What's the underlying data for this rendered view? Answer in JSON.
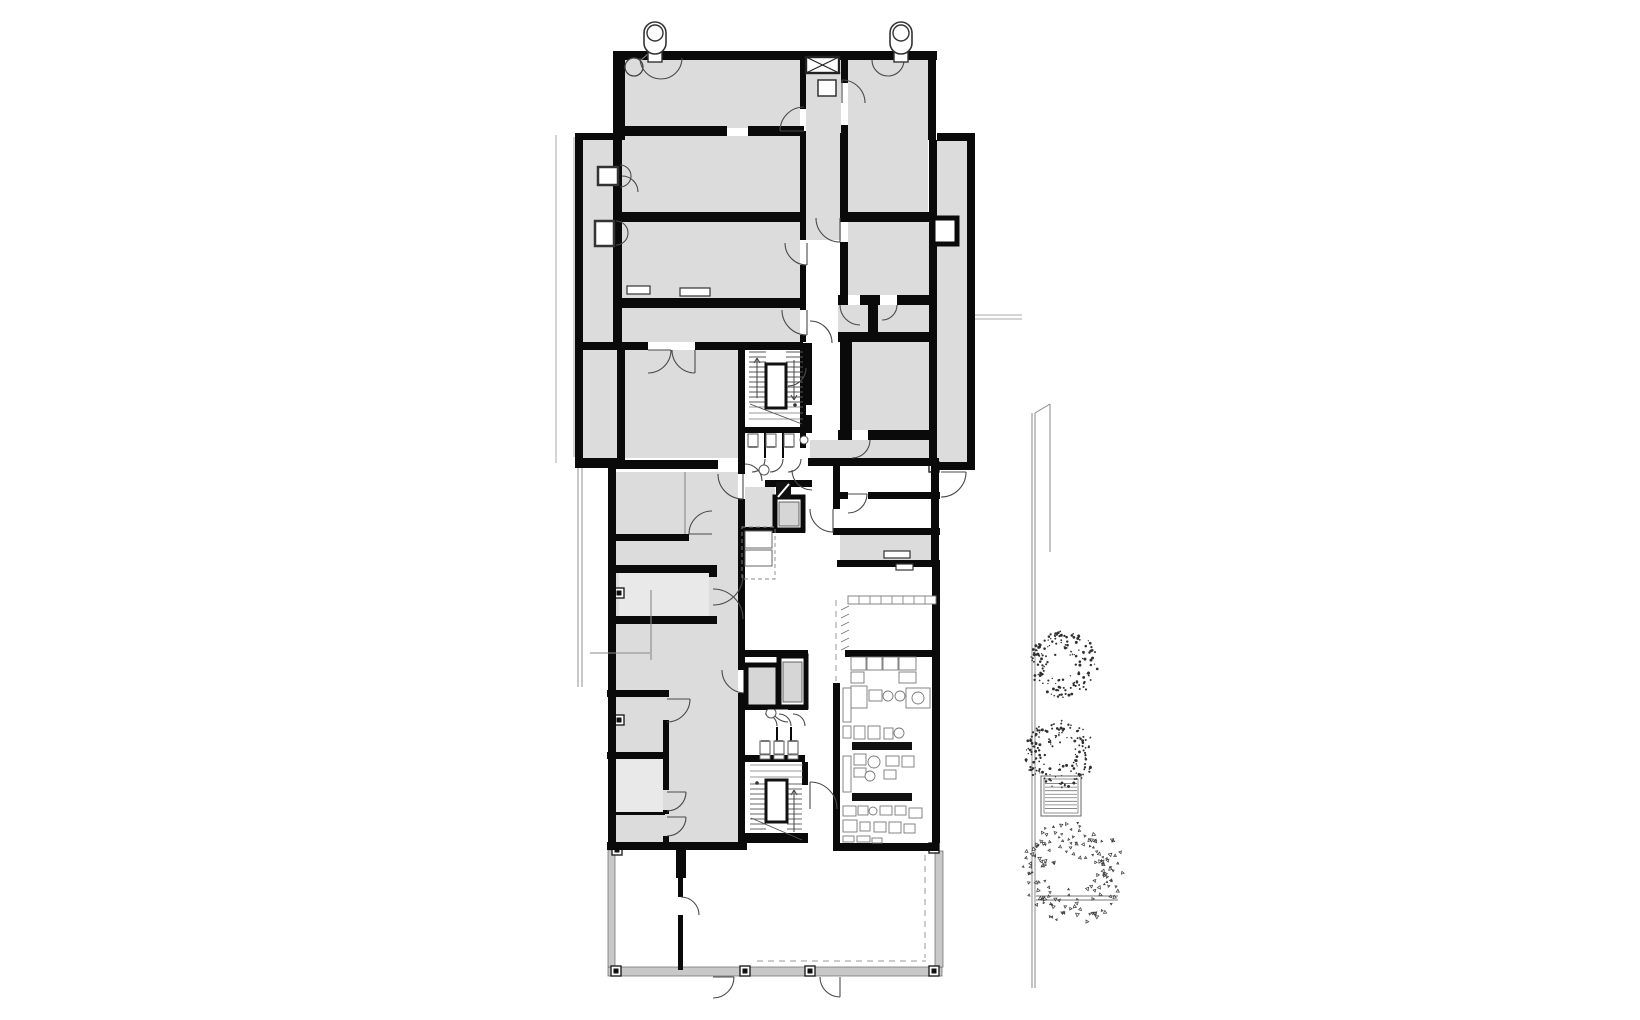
{
  "canvas": {
    "w": 1640,
    "h": 1020
  },
  "palette": {
    "wall": "#0a0a0a",
    "room": "#dcdcdc",
    "room_light": "#e9e9e9",
    "car": "#d6d6d6",
    "sill": "#c8c8c8",
    "door_line": "#4a4a4a",
    "equip_line": "#787878",
    "thin_line": "#a8a8a8",
    "glass_line": "#8f8f8f",
    "tree_dot": "#2f2f2f",
    "white": "#ffffff"
  },
  "fills": [
    [
      "r",
      625,
      60,
      175,
      68
    ],
    [
      "r",
      806,
      72,
      35,
      168
    ],
    [
      "r",
      848,
      60,
      80,
      152
    ],
    [
      "r",
      583,
      140,
      30,
      318
    ],
    [
      "r",
      622,
      136,
      178,
      76
    ],
    [
      "r",
      613,
      222,
      187,
      76
    ],
    [
      "r",
      613,
      308,
      187,
      34
    ],
    [
      "r",
      583,
      350,
      155,
      108
    ],
    [
      "r",
      848,
      222,
      82,
      73
    ],
    [
      "r",
      838,
      305,
      30,
      27
    ],
    [
      "r",
      878,
      305,
      52,
      27
    ],
    [
      "r",
      852,
      342,
      78,
      88
    ],
    [
      "r",
      810,
      440,
      120,
      18
    ],
    [
      "r",
      937,
      141,
      30,
      321
    ],
    [
      "r",
      615,
      472,
      123,
      371
    ],
    [
      "rl",
      619,
      573,
      90,
      43
    ],
    [
      "r",
      615,
      697,
      48,
      55
    ],
    [
      "rl",
      613,
      759,
      50,
      53
    ],
    [
      "r",
      613,
      815,
      50,
      27
    ],
    [
      "r",
      840,
      535,
      92,
      25
    ],
    [
      "r",
      745,
      487,
      30,
      40
    ]
  ],
  "walls": [
    [
      613,
      51,
      324,
      9
    ],
    [
      613,
      51,
      12,
      89
    ],
    [
      928,
      51,
      8,
      89
    ],
    [
      800,
      51,
      6,
      58
    ],
    [
      800,
      131,
      6,
      109
    ],
    [
      800,
      265,
      6,
      45
    ],
    [
      800,
      335,
      6,
      7
    ],
    [
      800,
      350,
      6,
      98
    ],
    [
      841,
      51,
      7,
      32
    ],
    [
      841,
      125,
      7,
      8
    ],
    [
      840,
      133,
      8,
      85
    ],
    [
      840,
      242,
      8,
      53
    ],
    [
      617,
      126,
      110,
      10
    ],
    [
      748,
      126,
      56,
      10
    ],
    [
      840,
      212,
      95,
      10
    ],
    [
      575,
      133,
      8,
      332
    ],
    [
      575,
      133,
      42,
      7
    ],
    [
      937,
      133,
      38,
      8
    ],
    [
      967,
      133,
      8,
      337
    ],
    [
      575,
      458,
      48,
      10
    ],
    [
      937,
      462,
      38,
      8
    ],
    [
      929,
      140,
      8,
      322
    ],
    [
      613,
      60,
      9,
      282
    ],
    [
      617,
      350,
      8,
      110
    ],
    [
      613,
      212,
      190,
      10
    ],
    [
      622,
      298,
      181,
      10
    ],
    [
      578,
      342,
      70,
      8
    ],
    [
      695,
      342,
      108,
      8
    ],
    [
      838,
      295,
      10,
      10
    ],
    [
      860,
      295,
      20,
      10
    ],
    [
      897,
      295,
      33,
      10
    ],
    [
      868,
      295,
      10,
      40
    ],
    [
      838,
      332,
      95,
      10
    ],
    [
      840,
      342,
      12,
      95
    ],
    [
      838,
      430,
      14,
      10
    ],
    [
      868,
      430,
      65,
      10
    ],
    [
      808,
      458,
      131,
      8
    ],
    [
      608,
      465,
      8,
      385
    ],
    [
      613,
      460,
      105,
      9
    ],
    [
      738,
      342,
      7,
      118
    ],
    [
      738,
      460,
      7,
      14
    ],
    [
      738,
      499,
      7,
      171
    ],
    [
      738,
      693,
      7,
      150
    ],
    [
      611,
      565,
      106,
      8
    ],
    [
      611,
      616,
      106,
      8
    ],
    [
      709,
      565,
      8,
      12
    ],
    [
      709,
      617,
      8,
      7
    ],
    [
      611,
      534,
      78,
      7
    ],
    [
      607,
      690,
      62,
      7
    ],
    [
      607,
      752,
      62,
      7
    ],
    [
      611,
      812,
      54,
      3
    ],
    [
      607,
      842,
      140,
      8
    ],
    [
      663,
      720,
      6,
      32
    ],
    [
      663,
      759,
      6,
      31
    ],
    [
      663,
      810,
      6,
      4
    ],
    [
      663,
      836,
      6,
      6
    ],
    [
      745,
      343,
      67,
      7
    ],
    [
      805,
      343,
      7,
      62
    ],
    [
      805,
      415,
      7,
      12
    ],
    [
      745,
      427,
      67,
      6
    ],
    [
      764,
      433,
      2,
      25
    ],
    [
      782,
      433,
      2,
      25
    ],
    [
      765,
      480,
      47,
      7
    ],
    [
      745,
      527,
      60,
      6
    ],
    [
      745,
      650,
      63,
      7
    ],
    [
      745,
      703,
      23,
      7
    ],
    [
      788,
      703,
      20,
      7
    ],
    [
      776,
      727,
      2,
      28
    ],
    [
      790,
      727,
      2,
      28
    ],
    [
      745,
      755,
      60,
      7
    ],
    [
      802,
      762,
      6,
      23
    ],
    [
      745,
      833,
      63,
      10
    ],
    [
      833,
      462,
      7,
      47
    ],
    [
      833,
      528,
      7,
      7
    ],
    [
      840,
      492,
      8,
      7
    ],
    [
      868,
      492,
      72,
      7
    ],
    [
      840,
      528,
      100,
      7
    ],
    [
      837,
      560,
      103,
      7
    ],
    [
      845,
      650,
      93,
      7
    ],
    [
      833,
      683,
      7,
      160
    ],
    [
      931,
      466,
      8,
      100
    ],
    [
      932,
      566,
      8,
      277
    ],
    [
      833,
      843,
      106,
      8
    ],
    [
      676,
      850,
      10,
      28
    ],
    [
      678,
      878,
      5,
      19
    ],
    [
      678,
      915,
      5,
      55
    ]
  ],
  "sills": [
    [
      608,
      967,
      334,
      9
    ],
    [
      608,
      850,
      7,
      117
    ],
    [
      935,
      851,
      8,
      116
    ]
  ],
  "columns": [
    [
      611,
      966
    ],
    [
      740,
      966
    ],
    [
      805,
      966
    ],
    [
      929,
      966
    ],
    [
      612,
      845
    ],
    [
      929,
      843
    ],
    [
      929,
      462
    ],
    [
      614,
      588
    ],
    [
      614,
      715
    ]
  ],
  "glass_lines": [
    [
      578,
      468,
      578,
      687
    ],
    [
      582,
      468,
      582,
      687
    ]
  ],
  "thin_lines": [
    [
      556,
      135,
      556,
      463
    ],
    [
      574,
      137,
      574,
      457
    ],
    [
      975,
      315,
      1022,
      315
    ],
    [
      975,
      319,
      1022,
      319
    ]
  ],
  "furniture_lines": [
    [
      590,
      653,
      650,
      653
    ],
    [
      651,
      590,
      651,
      660
    ],
    [
      685,
      472,
      685,
      534
    ],
    [
      641,
      60,
      648,
      54
    ]
  ],
  "dashed_lines": [
    [
      757,
      961,
      926,
      961
    ],
    [
      925,
      855,
      925,
      958
    ],
    [
      836,
      600,
      836,
      650
    ],
    [
      836,
      654,
      836,
      681
    ]
  ],
  "fence": {
    "main": [
      [
        1032,
        413,
        1032,
        988
      ],
      [
        1035,
        413,
        1035,
        988
      ]
    ],
    "diag": [
      1035,
      413,
      1050,
      404
    ],
    "aux": [
      1050,
      404,
      1050,
      552
    ],
    "ground": [
      [
        1036,
        896,
        1118,
        896
      ],
      [
        1036,
        900,
        1118,
        900
      ]
    ]
  },
  "doors": [
    [
      661,
      58,
      21,
      0,
      180,
      ""
    ],
    [
      888,
      60,
      16,
      0,
      180,
      ""
    ],
    [
      804,
      131,
      24,
      180,
      270,
      "l"
    ],
    [
      842,
      103,
      23,
      270,
      360,
      "l"
    ],
    [
      622,
      192,
      16,
      270,
      360,
      ""
    ],
    [
      807,
      243,
      22,
      90,
      180,
      "l"
    ],
    [
      840,
      218,
      24,
      90,
      180,
      "l"
    ],
    [
      807,
      310,
      25,
      90,
      180,
      "l"
    ],
    [
      648,
      350,
      23,
      0,
      90,
      "l"
    ],
    [
      695,
      350,
      23,
      90,
      180,
      "l"
    ],
    [
      860,
      305,
      20,
      90,
      180,
      ""
    ],
    [
      882,
      305,
      15,
      0,
      90,
      ""
    ],
    [
      852,
      440,
      18,
      0,
      90,
      ""
    ],
    [
      941,
      472,
      25,
      0,
      90,
      "l"
    ],
    [
      848,
      494,
      19,
      0,
      90,
      "l"
    ],
    [
      833,
      509,
      23,
      90,
      180,
      "l"
    ],
    [
      752,
      459,
      13,
      0,
      90,
      ""
    ],
    [
      770,
      459,
      13,
      0,
      90,
      ""
    ],
    [
      788,
      459,
      13,
      0,
      90,
      ""
    ],
    [
      745,
      481,
      17,
      270,
      360,
      ""
    ],
    [
      812,
      470,
      20,
      90,
      180,
      ""
    ],
    [
      743,
      474,
      25,
      90,
      180,
      "l"
    ],
    [
      712,
      534,
      23,
      180,
      270,
      "l"
    ],
    [
      713,
      575,
      30,
      0,
      90,
      ""
    ],
    [
      713,
      619,
      30,
      270,
      360,
      ""
    ],
    [
      745,
      670,
      23,
      90,
      180,
      "l"
    ],
    [
      788,
      705,
      17,
      90,
      180,
      ""
    ],
    [
      765,
      726,
      12,
      270,
      360,
      ""
    ],
    [
      779,
      726,
      12,
      270,
      360,
      ""
    ],
    [
      793,
      726,
      12,
      270,
      360,
      ""
    ],
    [
      810,
      809,
      27,
      270,
      360,
      "l"
    ],
    [
      667,
      699,
      23,
      0,
      90,
      "l"
    ],
    [
      667,
      792,
      19,
      0,
      90,
      "l"
    ],
    [
      667,
      817,
      19,
      0,
      90,
      "l"
    ],
    [
      681,
      915,
      18,
      270,
      360,
      ""
    ],
    [
      713,
      977,
      21,
      0,
      90,
      "l"
    ],
    [
      840,
      977,
      20,
      90,
      180,
      "l"
    ],
    [
      810,
      343,
      22,
      270,
      360,
      ""
    ],
    [
      788,
      368,
      18,
      0,
      90,
      ""
    ],
    [
      620,
      176,
      11,
      270,
      450,
      ""
    ],
    [
      616,
      233,
      12,
      270,
      450,
      ""
    ]
  ],
  "stairs": [
    {
      "box": [
        766,
        364,
        20,
        44
      ],
      "flights": [
        [
          749,
          352,
          17,
          11,
          5
        ],
        [
          786,
          352,
          17,
          11,
          5
        ]
      ],
      "landing": [
        [
          749,
          407,
          54
        ],
        [
          749,
          413,
          54
        ],
        [
          749,
          419,
          54
        ]
      ],
      "diag": [
        750,
        404,
        802,
        424
      ],
      "arrows": [
        [
          757,
          398,
          358
        ],
        [
          794,
          360,
          400
        ]
      ],
      "dot": [
        795,
        405
      ]
    },
    {
      "box": [
        766,
        780,
        21,
        42
      ],
      "flights": [
        [
          750,
          784,
          16,
          10,
          5
        ],
        [
          787,
          784,
          15,
          10,
          5
        ]
      ],
      "landing": [
        [
          750,
          765,
          53
        ],
        [
          750,
          771,
          53
        ],
        [
          750,
          777,
          53
        ]
      ],
      "diag": [
        751,
        818,
        802,
        840
      ],
      "arrows": [
        [
          794,
          832,
          790
        ]
      ],
      "dot": [
        757,
        783
      ]
    }
  ],
  "toilets": [
    [
      "s",
      748,
      434
    ],
    [
      "s",
      766,
      434
    ],
    [
      "s",
      784,
      434
    ],
    [
      "n",
      760,
      741
    ],
    [
      "n",
      774,
      741
    ],
    [
      "n",
      788,
      741
    ]
  ],
  "sinks": [
    [
      804,
      440,
      4
    ],
    [
      764,
      470,
      5
    ],
    [
      771,
      713,
      5
    ]
  ],
  "fixture_circle": [
    634,
    67,
    9
  ],
  "xbox": {
    "x": 806,
    "y": 57,
    "w": 33,
    "h": 16
  },
  "vents": [
    {
      "x": 644,
      "y": 22
    },
    {
      "x": 890,
      "y": 22
    }
  ],
  "duct_box": [
    933,
    218,
    24,
    26
  ],
  "hatch_shaft": [
    776,
    482,
    15,
    17
  ],
  "elevators": {
    "upper": {
      "shell": [
        775,
        497,
        28,
        33
      ],
      "car": [
        779,
        502,
        20,
        24
      ]
    },
    "lower_a": {
      "shell": [
        746,
        665,
        32,
        42
      ],
      "car": null
    },
    "lower_b": {
      "shell": [
        779,
        656,
        27,
        51
      ],
      "car": [
        783,
        662,
        19,
        40
      ]
    }
  },
  "kitchenette": {
    "dash": [
      742,
      527,
      33,
      52
    ],
    "boxes": [
      [
        745,
        531,
        27,
        17
      ],
      [
        745,
        550,
        27,
        16
      ]
    ]
  },
  "small_boxes": [
    [
      598,
      167,
      20,
      18,
      2.5
    ],
    [
      595,
      221,
      19,
      25,
      2.5
    ],
    [
      818,
      80,
      18,
      16,
      1.5
    ],
    [
      627,
      286,
      23,
      8,
      1.2
    ],
    [
      680,
      288,
      30,
      8,
      1.2
    ],
    [
      884,
      551,
      26,
      7,
      1.2
    ],
    [
      896,
      564,
      17,
      6,
      1.2
    ]
  ],
  "shelf": {
    "rect": [
      848,
      596,
      88,
      8
    ],
    "ticks": [
      859,
      870,
      881,
      892,
      903,
      914,
      925
    ]
  },
  "hatch_lines": [
    [
      841,
      610,
      849,
      606
    ],
    [
      841,
      618,
      849,
      614
    ],
    [
      841,
      626,
      849,
      622
    ],
    [
      841,
      634,
      849,
      630
    ],
    [
      841,
      642,
      849,
      638
    ],
    [
      841,
      650,
      849,
      646
    ],
    [
      844,
      695,
      851,
      690
    ],
    [
      844,
      705,
      851,
      700
    ],
    [
      844,
      715,
      851,
      710
    ],
    [
      844,
      765,
      851,
      760
    ],
    [
      844,
      775,
      851,
      770
    ],
    [
      844,
      785,
      851,
      780
    ]
  ],
  "counters": [
    [
      852,
      742,
      60,
      8
    ],
    [
      852,
      793,
      60,
      8
    ]
  ],
  "equip_rects": [
    [
      851,
      657,
      15,
      13
    ],
    [
      867,
      657,
      15,
      13
    ],
    [
      883,
      657,
      15,
      13
    ],
    [
      899,
      657,
      17,
      13
    ],
    [
      851,
      672,
      13,
      11
    ],
    [
      899,
      672,
      17,
      11
    ],
    [
      851,
      686,
      16,
      22
    ],
    [
      869,
      690,
      13,
      11
    ],
    [
      906,
      688,
      24,
      20
    ],
    [
      854,
      726,
      11,
      13
    ],
    [
      868,
      726,
      12,
      13
    ],
    [
      884,
      728,
      9,
      11
    ],
    [
      854,
      754,
      12,
      11
    ],
    [
      886,
      756,
      13,
      10
    ],
    [
      902,
      756,
      12,
      11
    ],
    [
      854,
      768,
      12,
      9
    ],
    [
      884,
      770,
      12,
      9
    ],
    [
      843,
      806,
      13,
      10
    ],
    [
      858,
      806,
      10,
      9
    ],
    [
      880,
      806,
      12,
      9
    ],
    [
      895,
      806,
      11,
      9
    ],
    [
      909,
      808,
      13,
      10
    ],
    [
      843,
      820,
      14,
      12
    ],
    [
      860,
      822,
      10,
      9
    ],
    [
      874,
      822,
      12,
      10
    ],
    [
      889,
      822,
      12,
      11
    ],
    [
      904,
      824,
      11,
      9
    ],
    [
      843,
      836,
      11,
      6
    ],
    [
      857,
      836,
      13,
      6
    ],
    [
      872,
      838,
      10,
      5
    ],
    [
      843,
      688,
      8,
      34
    ],
    [
      843,
      726,
      8,
      12
    ],
    [
      843,
      756,
      8,
      36
    ],
    [
      760,
      755,
      10,
      4
    ],
    [
      774,
      755,
      10,
      4
    ],
    [
      788,
      755,
      10,
      4
    ]
  ],
  "equip_circles": [
    [
      888,
      696,
      5
    ],
    [
      900,
      696,
      5
    ],
    [
      918,
      698,
      6
    ],
    [
      899,
      733,
      5
    ],
    [
      874,
      762,
      6
    ],
    [
      870,
      776,
      5
    ],
    [
      873,
      811,
      4
    ]
  ],
  "grate": {
    "x": 1041,
    "y": 776,
    "w": 40,
    "h": 40,
    "lines": 8
  },
  "trees": [
    {
      "cx": 1064,
      "cy": 664,
      "r": 33,
      "n": 160,
      "seed": 7,
      "style": "dot"
    },
    {
      "cx": 1060,
      "cy": 754,
      "r": 34,
      "n": 170,
      "seed": 11,
      "style": "dot"
    },
    {
      "cx": 1072,
      "cy": 872,
      "r": 50,
      "n": 150,
      "seed": 23,
      "style": "tri"
    }
  ]
}
